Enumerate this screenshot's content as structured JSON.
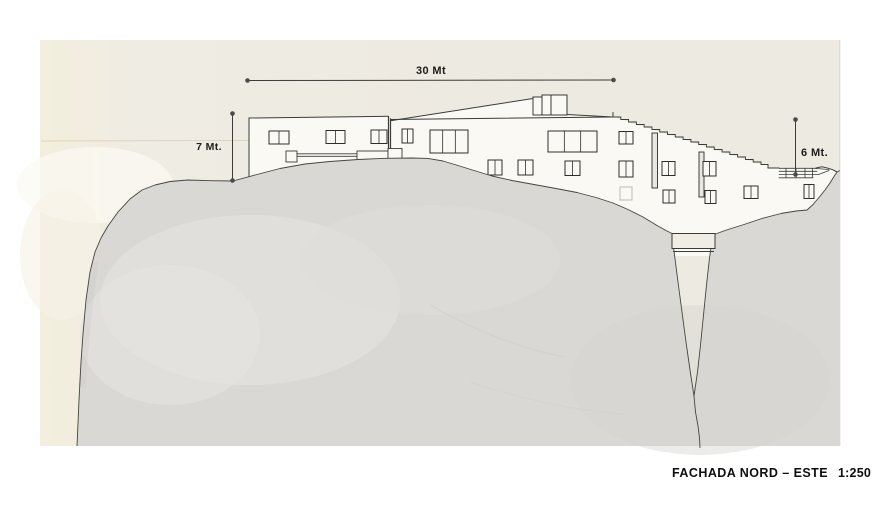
{
  "figure": {
    "caption": {
      "title": "FACHADA NORD – ESTE",
      "scale": "1:250"
    },
    "dimensions": {
      "width_label": "30 Mt",
      "left_height_label": "7 Mt.",
      "right_height_label": "6 Mt."
    },
    "colors": {
      "background": "#ffffff",
      "paper": "#eeebe2",
      "paper_warm": "#f4eedd",
      "terrain": "#d9d8d4",
      "terrain_light": "#e3e2de",
      "building": "#faf9f4",
      "line": "#3b3b38",
      "text": "#0e0e0e"
    },
    "windows": [
      {
        "x": 269,
        "y": 131,
        "w": 20,
        "h": 13,
        "panes": 2
      },
      {
        "x": 326,
        "y": 130.5,
        "w": 19,
        "h": 13,
        "panes": 2
      },
      {
        "x": 371,
        "y": 130,
        "w": 16,
        "h": 13.5,
        "panes": 2
      },
      {
        "x": 402,
        "y": 129,
        "w": 11,
        "h": 14,
        "panes": 2
      },
      {
        "x": 430,
        "y": 130,
        "w": 38,
        "h": 23,
        "panes": 3
      },
      {
        "x": 548,
        "y": 131,
        "w": 49,
        "h": 21,
        "panes": 3
      },
      {
        "x": 619,
        "y": 131.5,
        "w": 14,
        "h": 12.5,
        "panes": 2
      },
      {
        "x": 488,
        "y": 160,
        "w": 14,
        "h": 15,
        "panes": 2
      },
      {
        "x": 518,
        "y": 160,
        "w": 15,
        "h": 15,
        "panes": 2
      },
      {
        "x": 565,
        "y": 161,
        "w": 15,
        "h": 14.5,
        "panes": 2
      },
      {
        "x": 619,
        "y": 161,
        "w": 14,
        "h": 16,
        "panes": 2
      },
      {
        "x": 662,
        "y": 161.5,
        "w": 13,
        "h": 14,
        "panes": 2
      },
      {
        "x": 703,
        "y": 161.5,
        "w": 13,
        "h": 14.5,
        "panes": 2
      },
      {
        "x": 620,
        "y": 187,
        "w": 12,
        "h": 13,
        "panes": 1,
        "faint": true
      },
      {
        "x": 663,
        "y": 190,
        "w": 12,
        "h": 13,
        "panes": 2
      },
      {
        "x": 705,
        "y": 190.5,
        "w": 11,
        "h": 13,
        "panes": 2
      },
      {
        "x": 744,
        "y": 186,
        "w": 14,
        "h": 12.5,
        "panes": 2
      },
      {
        "x": 804,
        "y": 184.5,
        "w": 10,
        "h": 14,
        "panes": 2
      }
    ],
    "slats": [
      {
        "x": 652,
        "y": 133,
        "w": 5.5,
        "h": 55
      },
      {
        "x": 699,
        "y": 152,
        "w": 5,
        "h": 45
      }
    ],
    "sawtooth": {
      "x": 613,
      "y": 117,
      "steps": 19,
      "dx": 7.79,
      "dy": 2.5
    }
  }
}
